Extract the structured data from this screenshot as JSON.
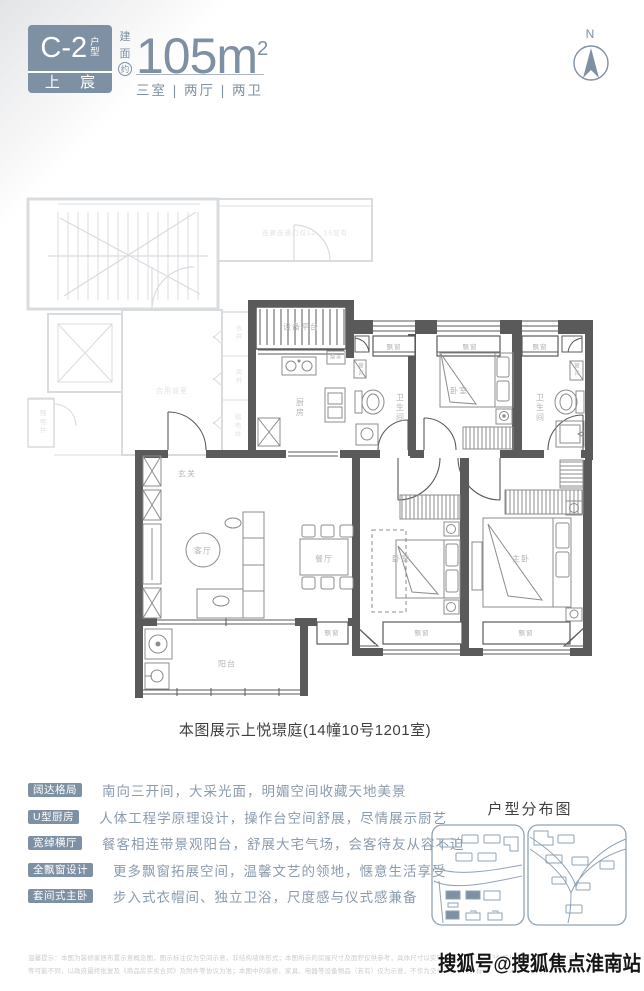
{
  "header": {
    "unit_code": "C-2",
    "unit_code_suffix_top": "户",
    "unit_code_suffix_bottom": "型",
    "brand_name": "上 宸",
    "area_char_1": "建",
    "area_char_2": "面",
    "area_char_3": "约",
    "area_value": "105m",
    "area_exponent": "2",
    "room_summary": "三室 | 两厅 | 两卫"
  },
  "compass": {
    "north_label": "N"
  },
  "floorplan": {
    "caption": "本图展示上悦璟庭(14幢10号1201室)",
    "labels": [
      {
        "text": "玄关",
        "x": 172,
        "y": 284
      },
      {
        "text": "厨房",
        "x": 285,
        "y": 218,
        "v": true
      },
      {
        "text": "设备平台",
        "x": 286,
        "y": 137
      },
      {
        "text": "烟道",
        "x": 321,
        "y": 167,
        "size": 5
      },
      {
        "text": "管井",
        "x": 345,
        "y": 180,
        "v": true,
        "size": 5.5
      },
      {
        "text": "卫生间",
        "x": 385,
        "y": 218,
        "v": true
      },
      {
        "text": "飘窗",
        "x": 379,
        "y": 156,
        "size": 6.5
      },
      {
        "text": "卧室",
        "x": 444,
        "y": 201
      },
      {
        "text": "飘窗",
        "x": 455,
        "y": 156,
        "size": 6.5
      },
      {
        "text": "飘窗",
        "x": 525,
        "y": 156,
        "size": 6.5
      },
      {
        "text": "管井",
        "x": 561,
        "y": 180,
        "v": true,
        "size": 5.5
      },
      {
        "text": "卫生间",
        "x": 525,
        "y": 218,
        "v": true
      },
      {
        "text": "客厅",
        "x": 188,
        "y": 361
      },
      {
        "text": "餐厅",
        "x": 309,
        "y": 369
      },
      {
        "text": "卧室",
        "x": 386,
        "y": 369
      },
      {
        "text": "主卧",
        "x": 506,
        "y": 369
      },
      {
        "text": "阳台",
        "x": 212,
        "y": 474
      },
      {
        "text": "飘窗",
        "x": 317,
        "y": 442,
        "size": 6.5
      },
      {
        "text": "飘窗",
        "x": 407,
        "y": 442,
        "size": 6.5
      },
      {
        "text": "飘窗",
        "x": 511,
        "y": 442,
        "size": 6.5
      },
      {
        "text": "连廊连通门仅12、15层有",
        "x": 290,
        "y": 42,
        "f": true,
        "size": 6.5
      },
      {
        "text": "水井",
        "x": 222,
        "y": 143,
        "v": true,
        "f": true,
        "size": 6.5
      },
      {
        "text": "风井",
        "x": 222,
        "y": 187,
        "v": true,
        "f": true,
        "size": 6.5
      },
      {
        "text": "弱电井",
        "x": 221,
        "y": 236,
        "v": true,
        "f": true,
        "size": 6.5
      },
      {
        "text": "合用前室",
        "x": 157,
        "y": 201,
        "f": true,
        "size": 7
      },
      {
        "text": "强电井",
        "x": 26,
        "y": 232,
        "v": true,
        "f": true,
        "size": 6.5
      }
    ]
  },
  "features": {
    "items": [
      {
        "tag": "阔达格局",
        "desc": "南向三开间，大采光面，明媚空间收藏天地美景"
      },
      {
        "tag": "U型厨房",
        "desc": "人体工程学原理设计，操作台空间舒展，尽情展示厨艺"
      },
      {
        "tag": "宽绰横厅",
        "desc": "餐客相连带景观阳台，舒展大宅气场，会客待友从容不迫"
      },
      {
        "tag": "全飘窗设计",
        "desc": "更多飘窗拓展空间，温馨文艺的领地，惬意生活享受"
      },
      {
        "tag": "套间式主卧",
        "desc": "步入式衣帽间、独立卫浴，尺度感与仪式感兼备"
      }
    ]
  },
  "distribution": {
    "title": "户型分布图"
  },
  "footer": {
    "disclaimer_line1": "温馨提示：本图为装修家居布置示意概念图，图示标注仅为空间示意，非结构墙体形式；本图所示的房屋尺寸及面积仅供参考，具体尺寸以实际交付为准。相同户型因楼栋、单元、楼层不同，飘窗、阳台、结构、管井、门窗位置、外立面、设备平台",
    "disclaimer_line2": "等可能不同，以政府最终批复及《商品房买卖合同》及附件等协议为准；本图中的装修、家具、电器等设备物品（若有）仅为示意，不作为交付内容和交付标准。出卖人在不违反国家法律法规",
    "watermark": "搜狐号@搜狐焦点淮南站"
  },
  "colors": {
    "accent": "#7E90A3",
    "wall": "#5A5A5A",
    "faded": "#D9DCDF"
  }
}
